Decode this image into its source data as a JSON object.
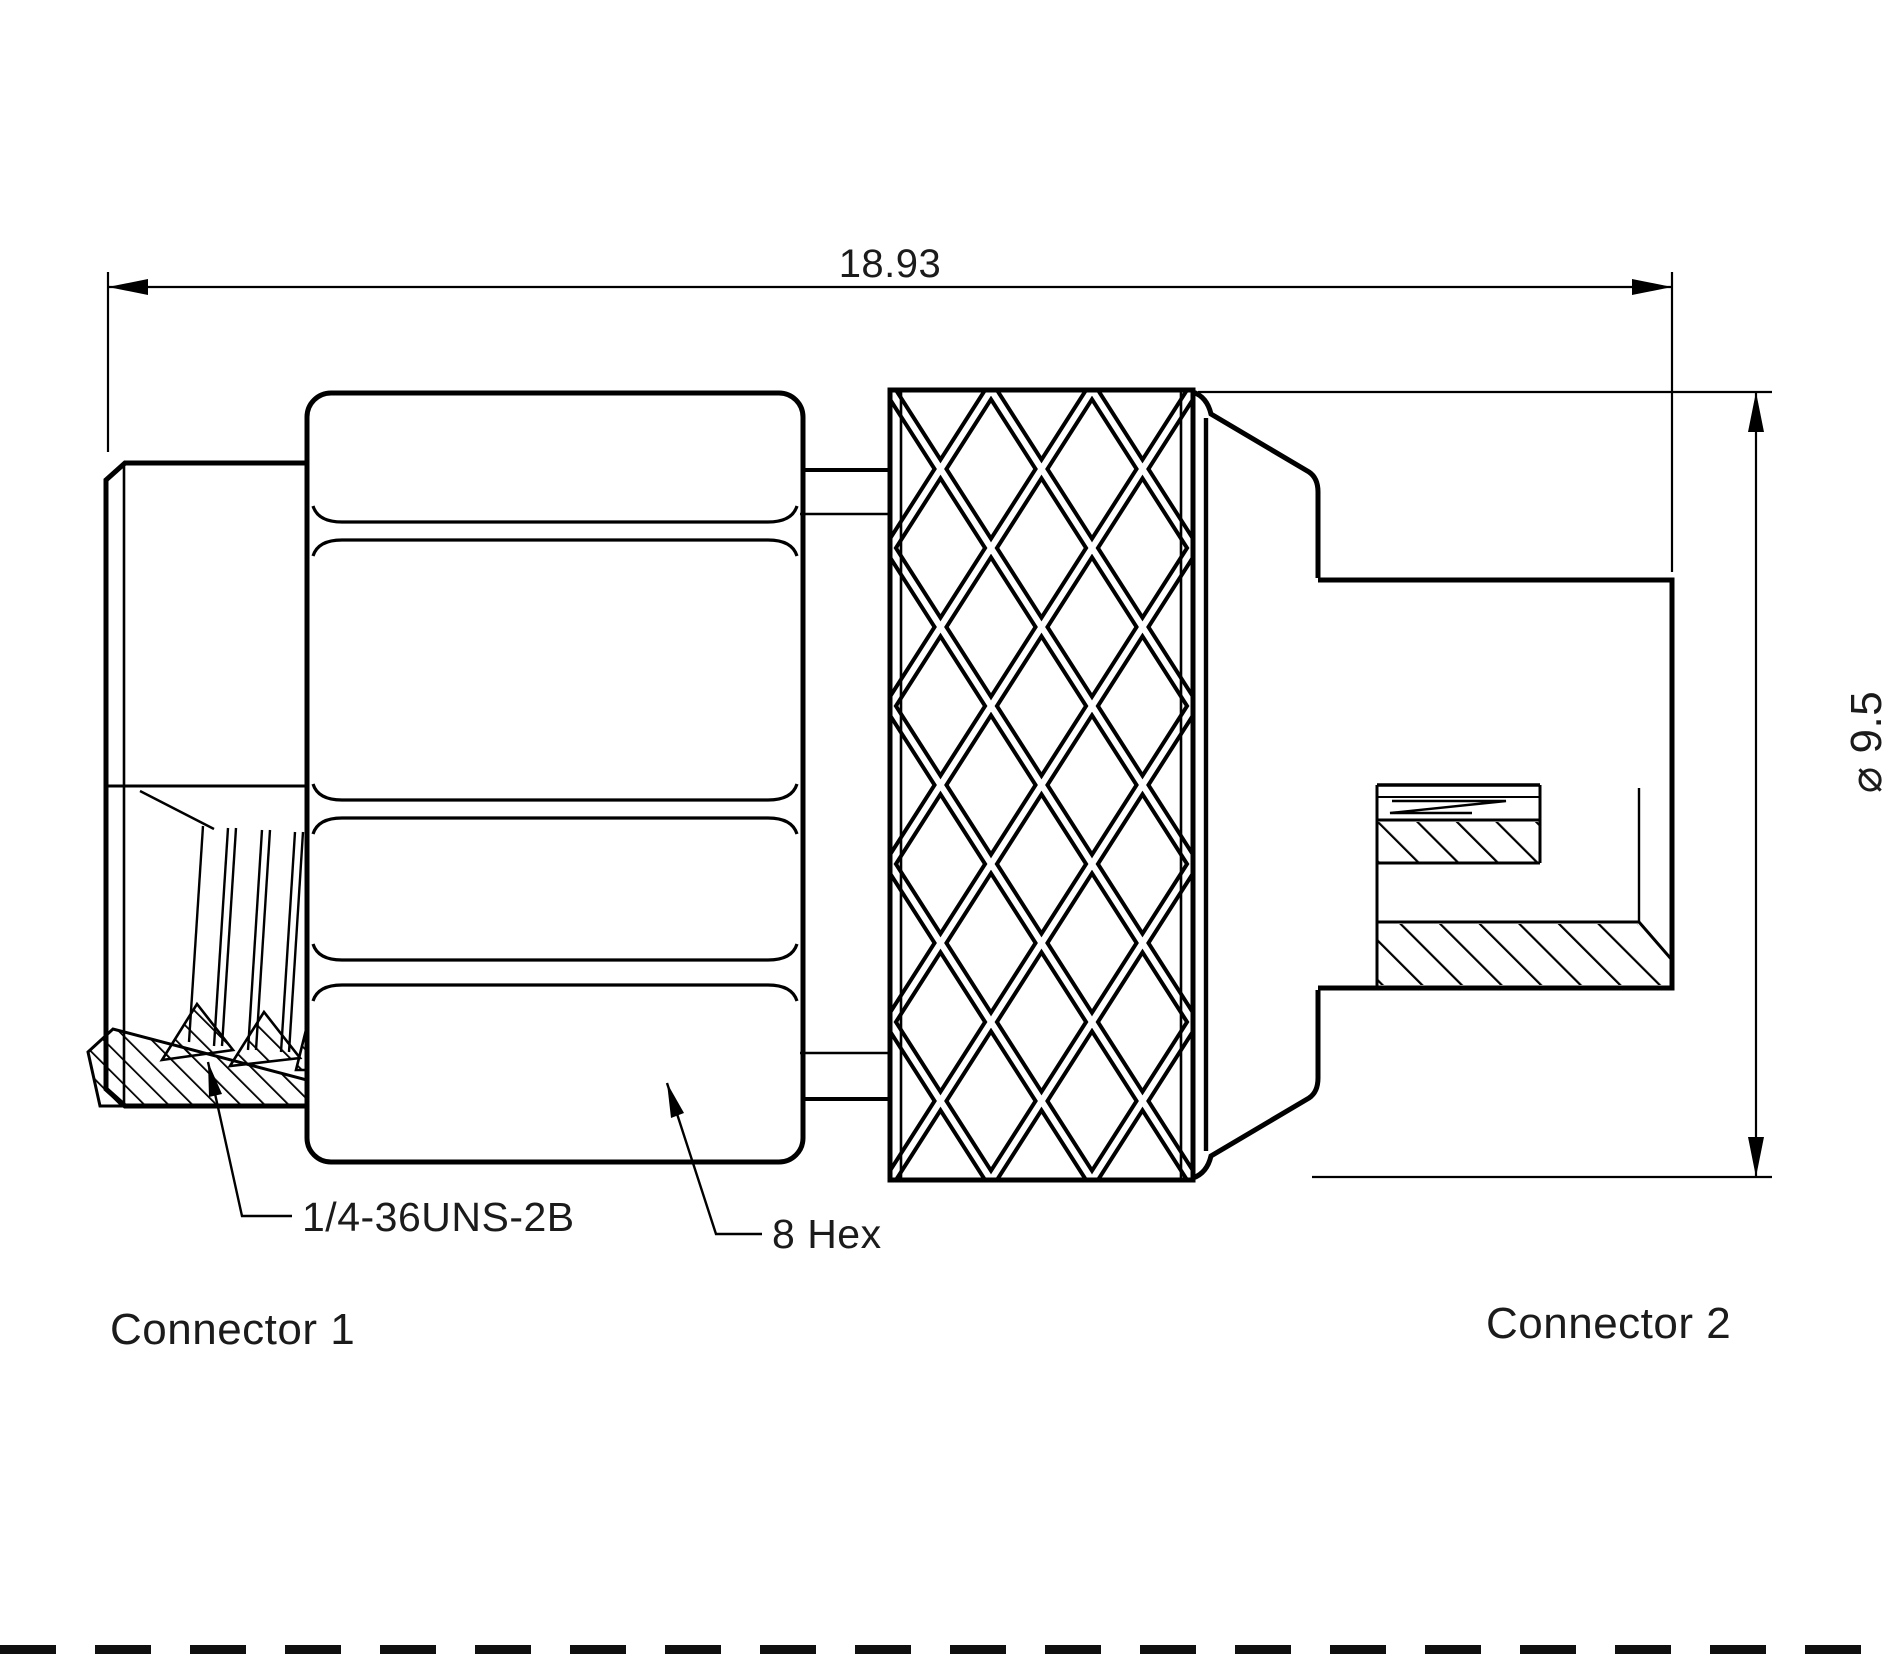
{
  "drawing": {
    "type": "technical-drawing",
    "dimensions": {
      "overall_length": "18.93",
      "body_diameter": "⌀ 9.5"
    },
    "annotations": {
      "thread_spec": "1/4-36UNS-2B",
      "hex_size": "8 Hex"
    },
    "connectors": {
      "left": "Connector 1",
      "right": "Connector 2"
    },
    "colors": {
      "line": "#000000",
      "text": "#1b1b1b",
      "background": "#ffffff"
    }
  }
}
